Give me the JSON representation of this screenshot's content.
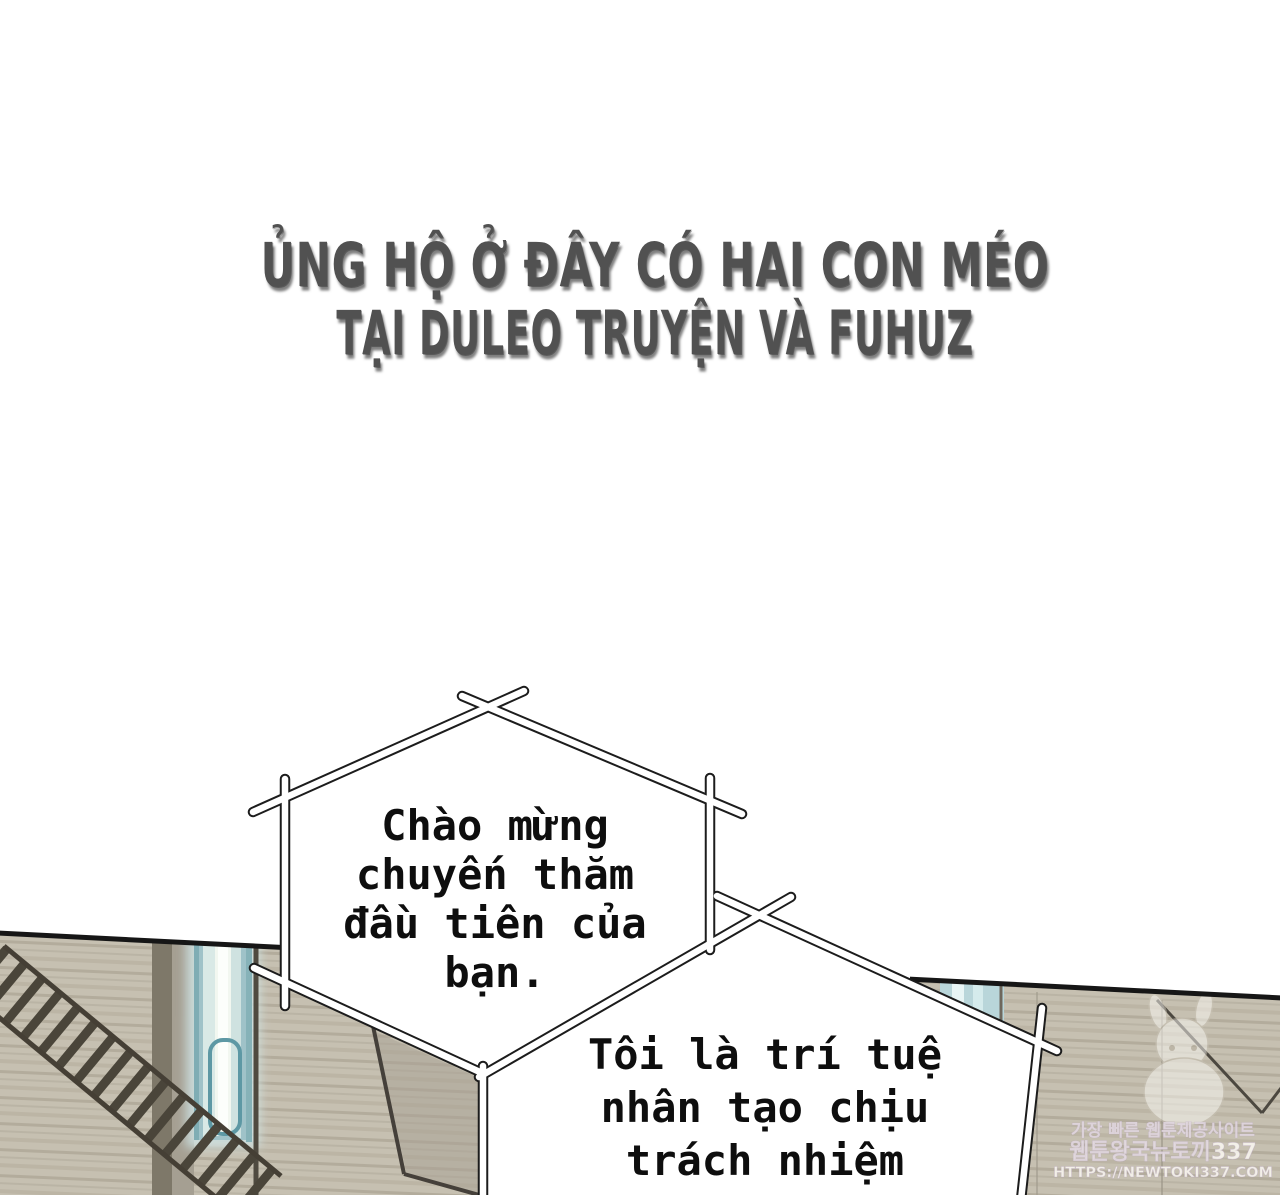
{
  "page": {
    "kind": "webtoon-comic-page",
    "background_color": "#ffffff"
  },
  "credit_banner": {
    "line1": "ỦNG HỘ Ở ĐÂY CÓ HAI CON MÉO",
    "line2": "TẠI DULEO TRUYỆN VÀ FUHUZ",
    "text_color": "#515151"
  },
  "speech_bubbles": [
    {
      "style": "stick-frame",
      "lines": [
        "Chào mừng",
        "chuyến thăm",
        "đầu tiên của",
        "bạn."
      ]
    },
    {
      "style": "stick-frame",
      "lines": [
        "Tôi là trí tuệ",
        "nhân tạo chịu",
        "trách nhiệm"
      ]
    }
  ],
  "watermark": {
    "tagline": "가장 빠른 웹툰제공사이트",
    "site_name": "웹툰왕국뉴토끼337",
    "url": "HTTPS://NEWTOKI337.COM",
    "mascot": "rabbit-mascot"
  },
  "artwork": {
    "colors": {
      "wall": "#c6c0b1",
      "panel_edge": "#161616",
      "led_tube_glow": "#f2f7f0",
      "led_tube_rim": "#86b2b8",
      "ladder": "#4a453a"
    }
  }
}
